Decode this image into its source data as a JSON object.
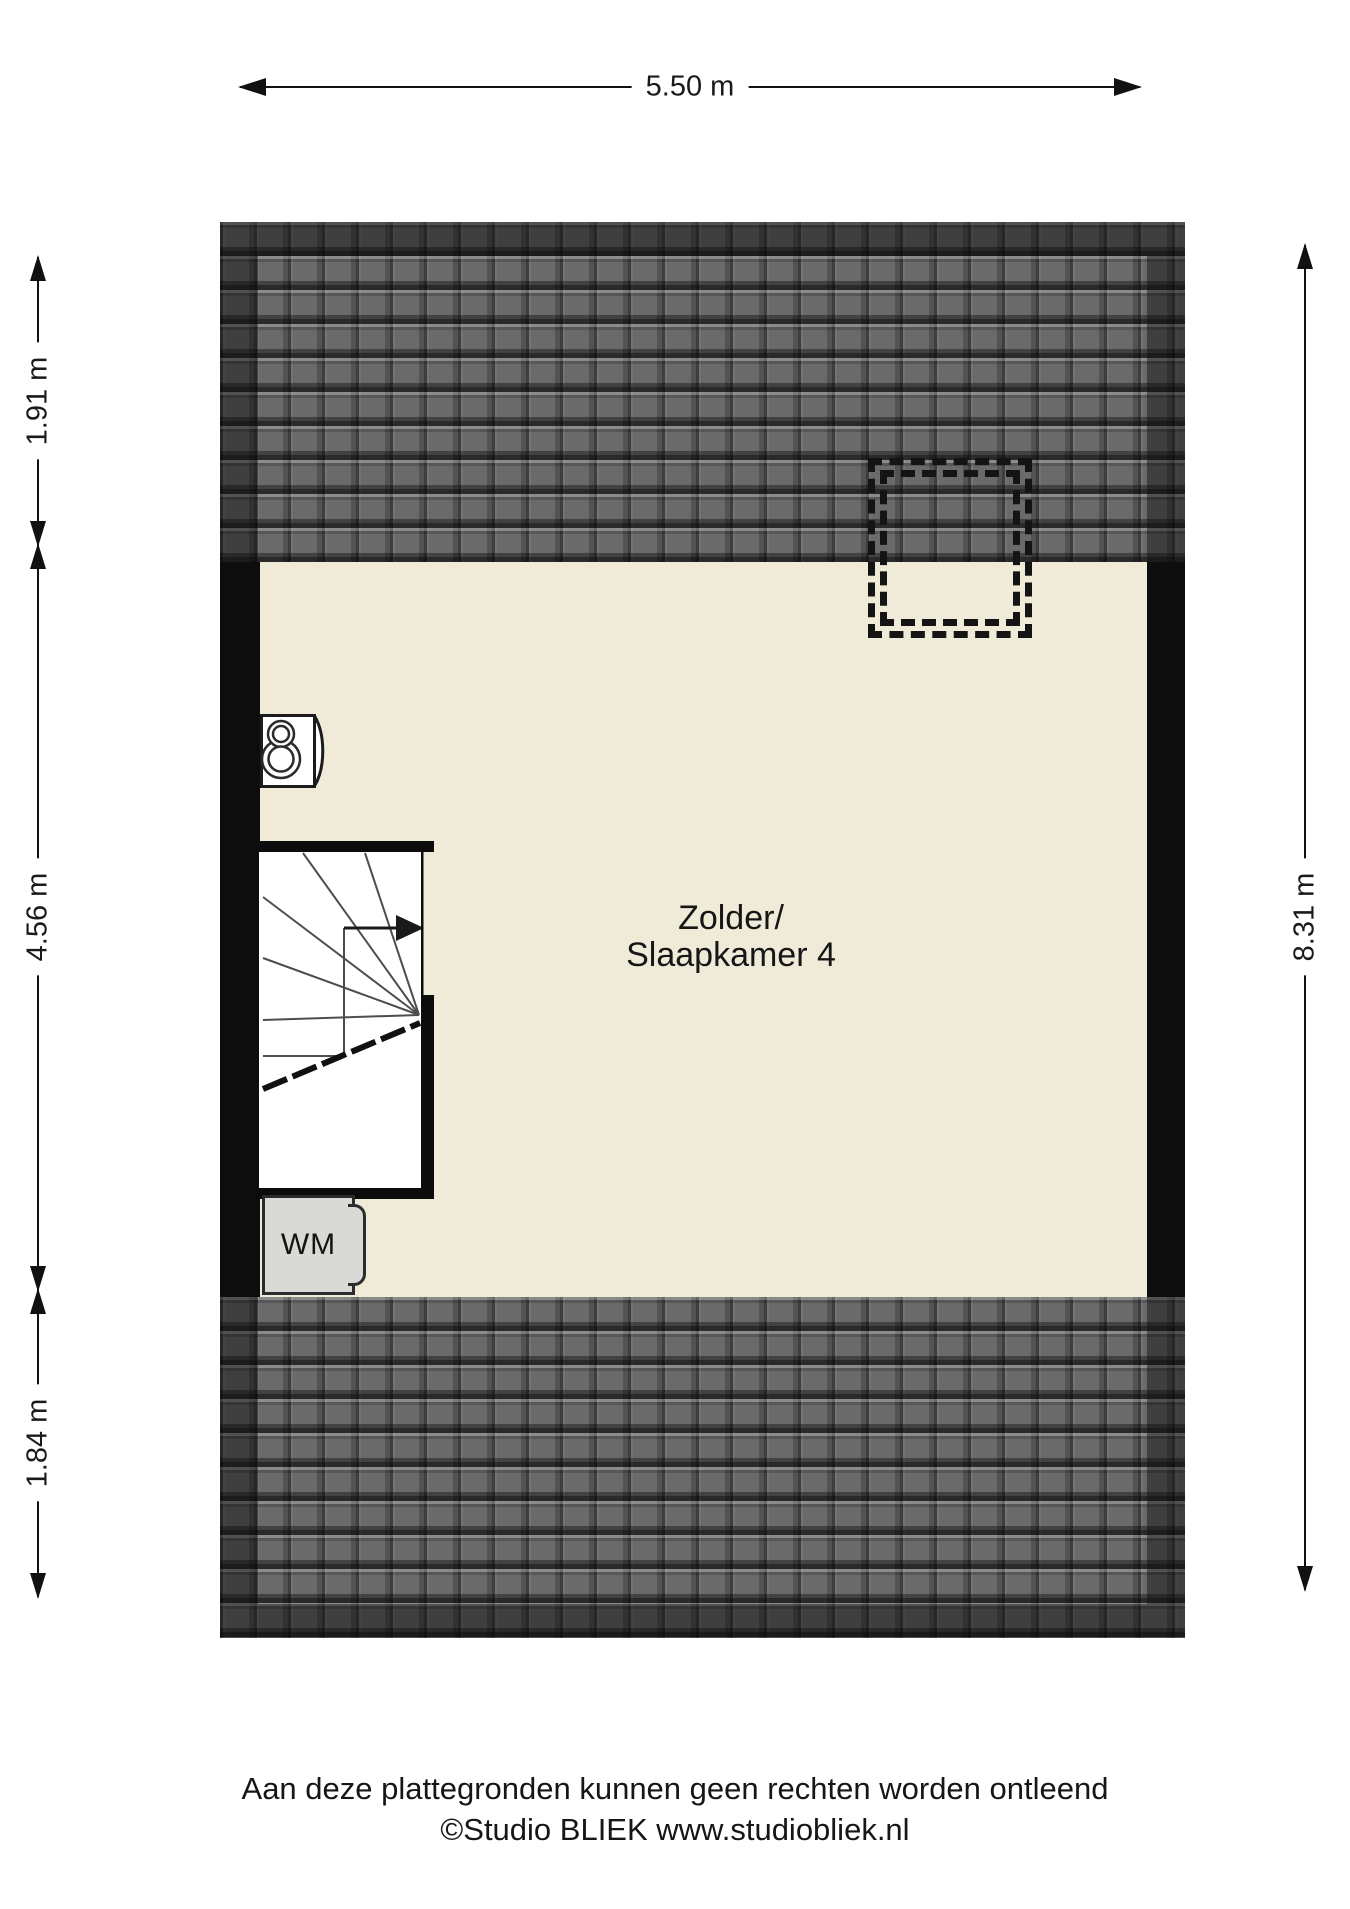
{
  "plan": {
    "room": {
      "label_line1": "Zolder/",
      "label_line2": "Slaapkamer 4"
    },
    "washing_machine": {
      "label": "WM"
    },
    "icons": {
      "boiler": "double-circle-keyhole-shape",
      "staircase": "winder-stairs-with-up-arrow",
      "skylight": "double-dashed-rectangle"
    }
  },
  "dimensions": {
    "top": {
      "label": "5.50 m"
    },
    "left": [
      {
        "label": "1.91 m"
      },
      {
        "label": "4.56 m"
      },
      {
        "label": "1.84 m"
      }
    ],
    "right": {
      "label": "8.31 m"
    }
  },
  "footer": {
    "disclaimer": "Aan deze plattegronden kunnen geen rechten worden ontleend",
    "credit": "©Studio BLIEK www.studiobliek.nl"
  },
  "colors": {
    "background": "#ffffff",
    "floor": "#f0ead9",
    "wall": "#0d0d0d",
    "roof_tile": "#6a6a6a",
    "appliance_fill": "#d9d9d5",
    "line": "#111111"
  }
}
